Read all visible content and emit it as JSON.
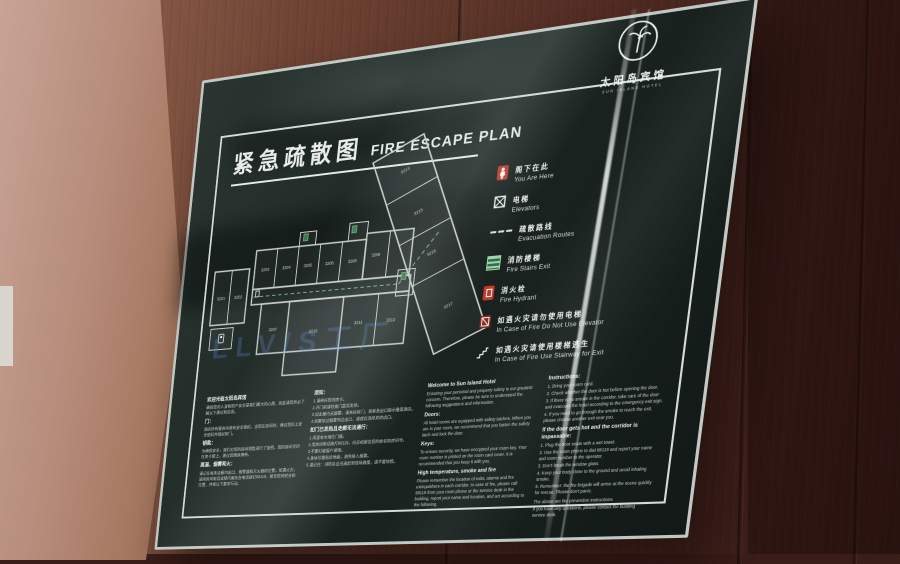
{
  "logo": {
    "name_zh": "太阳岛宾馆",
    "name_en": "SUN ISLAND HOTEL"
  },
  "title": {
    "zh": "紧急疏散图",
    "en": "FIRE ESCAPE PLAN"
  },
  "legend": {
    "items": [
      {
        "icon": "you-are-here-icon",
        "zh": "阁下在此",
        "en": "You Are Here"
      },
      {
        "icon": "elevator-icon",
        "zh": "电梯",
        "en": "Elevators"
      },
      {
        "icon": "evacuation-route-icon",
        "zh": "疏散路线",
        "en": "Evacuation Routes"
      },
      {
        "icon": "fire-stairs-icon",
        "zh": "消防楼梯",
        "en": "Fire Stairs Exit"
      },
      {
        "icon": "fire-hydrant-icon",
        "zh": "消火栓",
        "en": "Fire Hydrant"
      },
      {
        "icon": "no-elevator-icon",
        "zh": "如遇火灾请勿使用电梯",
        "en": "In Case of Fire Do Not Use Elevator"
      },
      {
        "icon": "stairway-exit-icon",
        "zh": "如遇火灾请使用楼梯逃生",
        "en": "In Case of Fire Use Stairway for Exit"
      }
    ]
  },
  "plan": {
    "rooms": [
      "3201",
      "3202",
      "3203",
      "3204",
      "3205",
      "3206",
      "3207",
      "3208",
      "3209",
      "3210",
      "3211",
      "3212",
      "3213",
      "3215",
      "3216",
      "3217"
    ]
  },
  "watermark_text": "LLV/S工厂",
  "colors": {
    "panel": "#1d2724",
    "accent_red": "#c0392b",
    "stairs_green": "#2f7d4f",
    "frame": "#dde3df",
    "wood": "#5d3529"
  },
  "sections": {
    "zh_welcome": {
      "heading": "欢迎光临太阳岛宾馆",
      "intro": "确保您的人身和财产安全是我们最大的心愿，因此请您务必了解以下建议和信息。",
      "blocks": [
        {
          "h": "门：",
          "p": "酒店所有客房均装有安全锁扣。当您在房间时，建议您扣上安全锁扣并锁好房门。"
        },
        {
          "h": "钥匙：",
          "p": "为确保安全，我们对您的房间钥匙进行了加密。您的房间号印在房卡套上，建议您随身携带。"
        },
        {
          "h": "高温、烟雾和火：",
          "p": "请记住每条走廊内出口、报警器和灭火器的位置。如遇火灾，请用房间电话或楼内服务台电话拨打88119，报告您的姓名和位置，并按以下要求行动。"
        }
      ]
    },
    "zh_instructions": {
      "heading": "须知：",
      "lines": [
        "1.请带好您的房卡。",
        "2.开门前请检查门是否发热。",
        "3.如走廊内无烟雾，请关好房门，按紧急出口指示撤离酒店。",
        "4.如需穿过烟雾到达出口，请就近选择其他出口。"
      ],
      "heading2": "如门已发热且走廊无法通行：",
      "lines2": [
        "1.用湿毛巾堵住门缝。",
        "2.用房间电话拨打88119，向总机报告您的姓名和房间号。",
        "3.不要打破窗户玻璃。",
        "4.身体尽量贴近地面，避免吸入烟雾。",
        "5.请记住：消防队会迅速赶到现场救援，请不要惊慌。"
      ]
    },
    "en_welcome": {
      "heading": "Welcome to Sun Island Hotel",
      "intro": "Ensuring your personal and property safety is our greatest concern. Therefore, please be sure to understand the following suggestions and information.",
      "blocks": [
        {
          "h": "Doors:",
          "p": "All hotel rooms are equipped with safety latches. When you are in your room, we recommend that you fasten the safety latch and lock the door."
        },
        {
          "h": "Keys:",
          "p": "To ensure security, we have encrypted your room key. Your room number is printed on the room card cover. It is recommended that you keep it with you."
        },
        {
          "h": "High temperature, smoke and fire",
          "p": "Please remember the location of exits, alarms and fire extinguishers in each corridor. In case of fire, please call 88119 from your room phone or the service desk in the building, report your name and location, and act according to the following."
        }
      ]
    },
    "en_instructions": {
      "heading": "Instructions:",
      "lines": [
        "1. Bring your room card.",
        "2. Check whether the door is hot before opening the door.",
        "3. If there is no smoke in the corridor, take care of the door and evacuate the hotel according to the emergency exit sign.",
        "4. If you need to go through the smoke to reach the exit, please choose another exit near you."
      ],
      "heading2": "If the door gets hot and the corridor is impassable:",
      "lines2": [
        "1. Plug the door seam with a wet towel.",
        "2. Use the room phone to dial 88119 and report your name and room number to the operator.",
        "3. Don't break the window glass.",
        "4. Keep your body close to the ground and avoid inhaling smoke.",
        "5. Remember: the fire brigade will arrive at the scene quickly for rescue. Please don't panic."
      ],
      "footer": [
        "The above are fire prevention instructions.",
        "If you have any questions, please contact the building service desk."
      ]
    }
  }
}
